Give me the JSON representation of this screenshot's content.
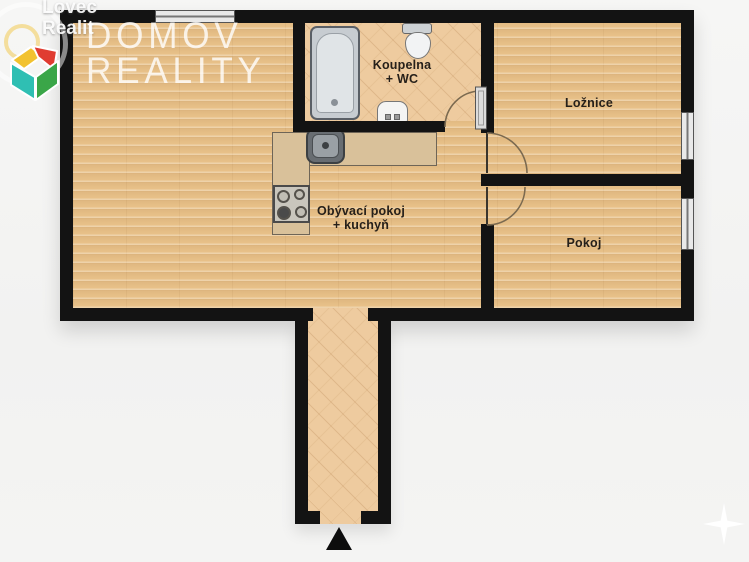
{
  "watermark": {
    "site_line1": "Lovec",
    "site_line2": "Realit",
    "agency_line1": "DOMOV",
    "agency_line2": "REALITY"
  },
  "rooms": {
    "bathroom": {
      "label_line1": "Koupelna",
      "label_line2": "+ WC"
    },
    "bedroom": {
      "label": "Ložnice"
    },
    "small_room": {
      "label": "Pokoj"
    },
    "living_room": {
      "label_line1": "Obývací pokoj",
      "label_line2": "+ kuchyň"
    }
  },
  "symbols": {
    "entrance_arrow": "entrance-direction-arrow",
    "compass": "compass-star",
    "windows": 3,
    "doors": 3
  },
  "colors": {
    "wall": "#131313",
    "wood_floor": "#e8c189",
    "tile_floor": "#eecb9f",
    "counter": "#d9c19a",
    "background": "#f4f4f3",
    "logo_teal": "#2fbfb3",
    "logo_green": "#3aa648",
    "logo_yellow": "#f2c230",
    "logo_red": "#e03c31"
  }
}
